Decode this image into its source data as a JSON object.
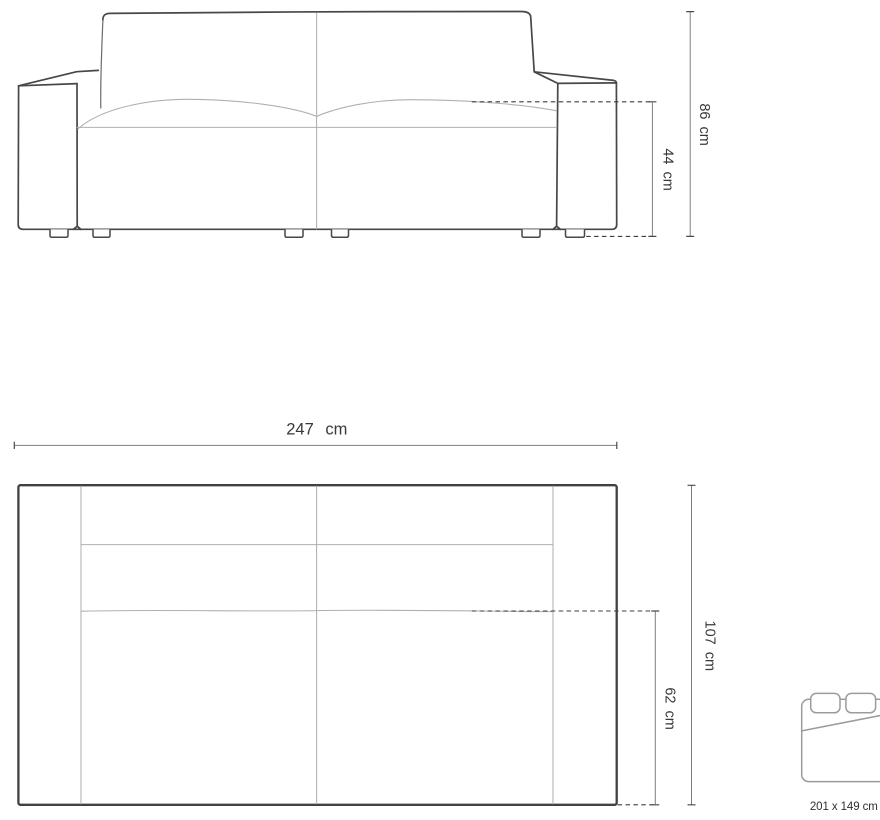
{
  "front_view": {
    "dimensions": [
      {
        "id": "total-height",
        "label": "86 cm",
        "value_cm": 86
      },
      {
        "id": "seat-height",
        "label": "44 cm",
        "value_cm": 44
      }
    ]
  },
  "top_view": {
    "dimensions": [
      {
        "id": "total-width",
        "label": "247 cm",
        "value_cm": 247
      },
      {
        "id": "total-depth",
        "label": "107 cm",
        "value_cm": 107
      },
      {
        "id": "seat-depth",
        "label": "62 cm",
        "value_cm": 62
      }
    ]
  },
  "sleeping_area": {
    "label": "201 x 149 cm",
    "width_cm": 201,
    "depth_cm": 149
  },
  "colors": {
    "background": "#ffffff",
    "outline": "#474747",
    "seam": "#b0b0b0",
    "dimension_line": "#7f7f7f",
    "dashed_line": "#3f3f3f",
    "label_text": "#383838",
    "bed_icon": "#9c9c9c"
  }
}
